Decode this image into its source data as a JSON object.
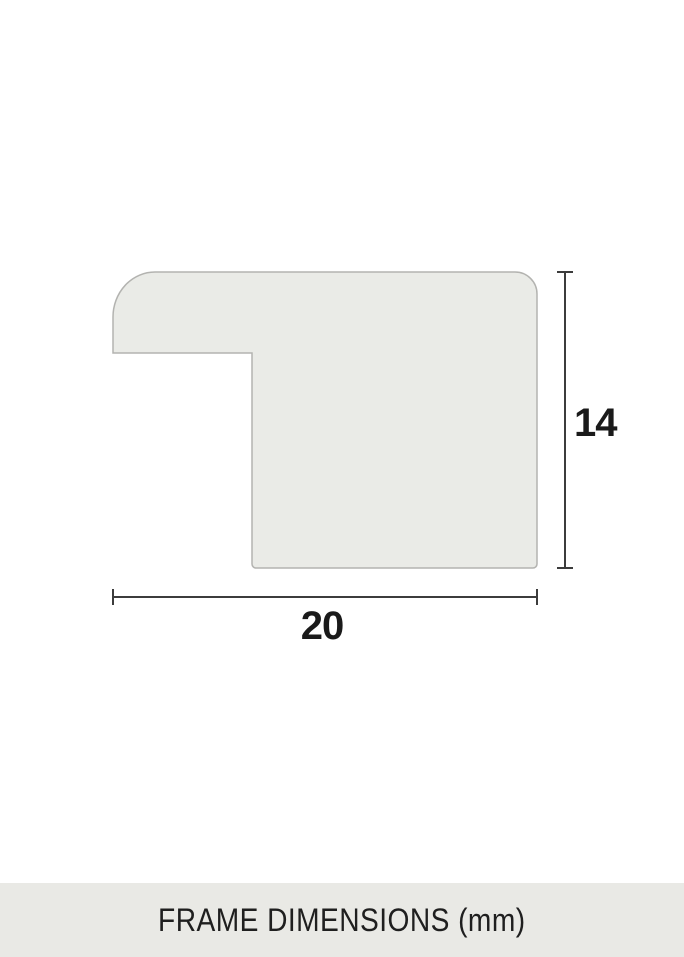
{
  "diagram": {
    "name": "frame-profile-cross-section",
    "height_label": "14",
    "width_label": "20",
    "shape_fill_color": "#eaebe7",
    "shape_stroke_color": "#b3b3b0",
    "dimension_line_color": "#3c3c3c",
    "label_text_color": "#1a1a1a"
  },
  "footer": {
    "caption": "FRAME DIMENSIONS (mm)",
    "background_color": "#e9e9e5",
    "text_color": "#1f1f1f"
  }
}
